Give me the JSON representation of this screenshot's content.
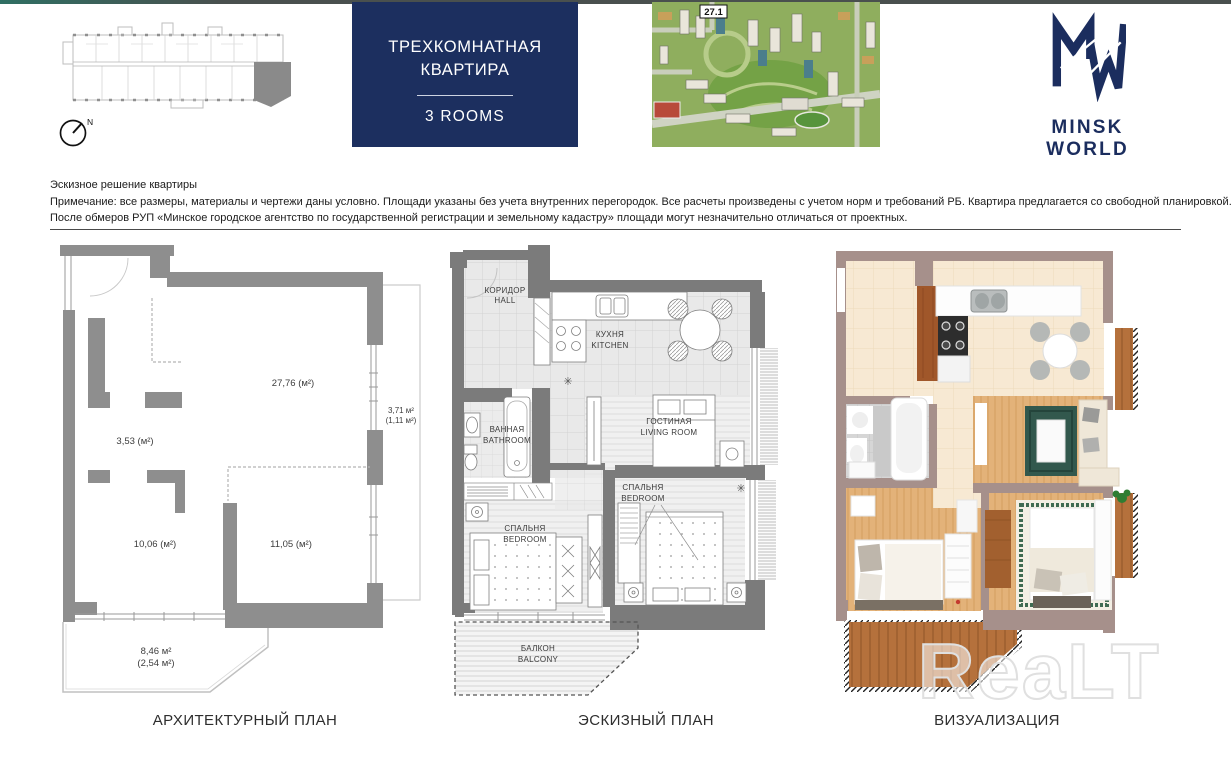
{
  "header": {
    "unit_type_ru_1": "ТРЕХКОМНАТНАЯ",
    "unit_type_ru_2": "КВАРТИРА",
    "unit_type_en": "3 ROOMS",
    "block_number": "27.1",
    "brand_name": "MINSK WORLD",
    "compass_north": "N"
  },
  "disclaimer": {
    "line1": "Эскизное решение квартиры",
    "line2": "Примечание: все размеры, материалы и чертежи даны условно. Площади указаны без учета внутренних перегородок. Все расчеты произведены с учетом норм и требований РБ. Квартира предлагается со свободной планировкой.",
    "line3": "После обмеров РУП «Минское городское агентство по государственной регистрации и земельному кадастру» площади могут незначительно отличаться от проектных."
  },
  "plans": {
    "architectural": {
      "caption": "АРХИТЕКТУРНЫЙ ПЛАН",
      "areas": {
        "living_room": "27,76 (м²)",
        "bathroom": "3,53 (м²)",
        "bedroom_left": "10,06 (м²)",
        "bedroom_right": "11,05 (м²)",
        "loggia_full": "3,71 м²",
        "loggia_reduced": "(1,11 м²)",
        "balcony_full": "8,46 м²",
        "balcony_reduced": "(2,54 м²)"
      }
    },
    "sketch": {
      "caption": "ЭСКИЗНЫЙ ПЛАН",
      "rooms": {
        "hall": {
          "ru": "КОРИДОР",
          "en": "HALL"
        },
        "kitchen": {
          "ru": "КУХНЯ",
          "en": "KITCHEN"
        },
        "bathroom": {
          "ru": "ВАННАЯ",
          "en": "BATHROOM"
        },
        "living": {
          "ru": "ГОСТИНАЯ",
          "en": "LIVING ROOM"
        },
        "bedroom_left": {
          "ru": "СПАЛЬНЯ",
          "en": "BEDROOM"
        },
        "bedroom_right": {
          "ru": "СПАЛЬНЯ",
          "en": "BEDROOM"
        },
        "balcony": {
          "ru": "БАЛКОН",
          "en": "BALCONY"
        }
      }
    },
    "visualization": {
      "caption": "ВИЗУАЛИЗАЦИЯ"
    }
  },
  "symbols": {
    "fridge_snowflake": "✳",
    "plant": "✳"
  },
  "watermark": "ReaLT",
  "colors": {
    "brand_navy": "#1c2f5f",
    "plan_wall_gray": "#8e8e8e",
    "sketch_wall_gray": "#7b7b7b",
    "viz_wall_taupe": "#a6908b",
    "topbar_teal": "#2f6f63"
  }
}
